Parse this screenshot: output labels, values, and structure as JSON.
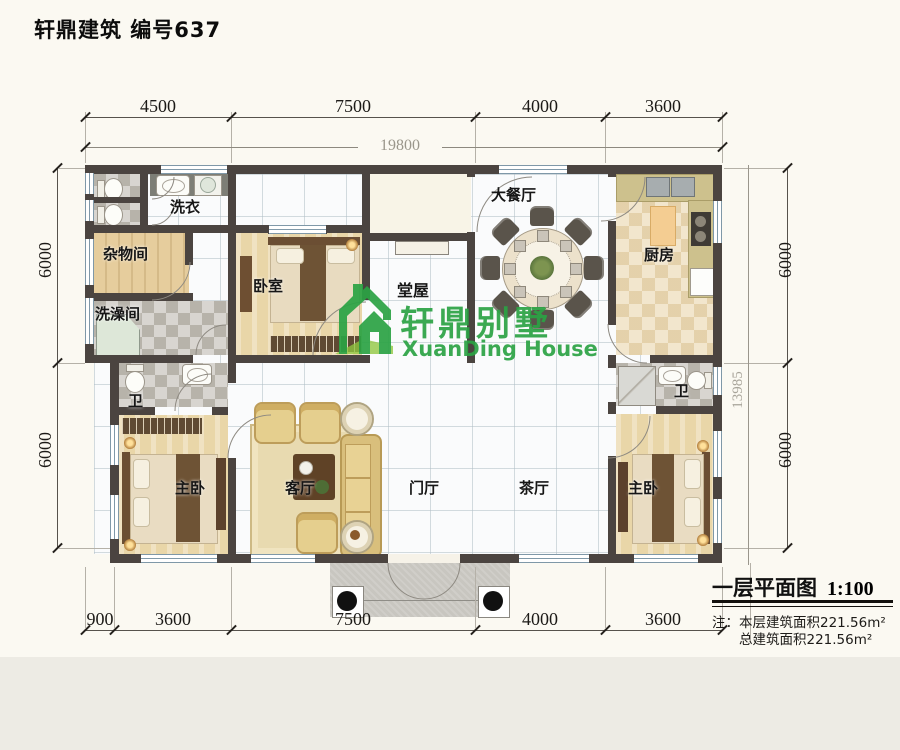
{
  "header": {
    "title": "轩鼎建筑 编号637"
  },
  "watermark": {
    "cn": "轩鼎别墅",
    "en": "XuanDing House",
    "logo_icon": "house-logo",
    "color": "#2ba344"
  },
  "rooms": {
    "laundry": {
      "label": "洗衣"
    },
    "storage": {
      "label": "杂物间"
    },
    "shower_room": {
      "label": "洗澡间"
    },
    "wc_left": {
      "label": "卫"
    },
    "master_left": {
      "label": "主卧"
    },
    "bedroom": {
      "label": "卧室"
    },
    "hall": {
      "label": "堂屋"
    },
    "living": {
      "label": "客厅"
    },
    "foyer": {
      "label": "门厅"
    },
    "tea_hall": {
      "label": "茶厅"
    },
    "dining": {
      "label": "大餐厅"
    },
    "kitchen": {
      "label": "厨房"
    },
    "wc_right": {
      "label": "卫"
    },
    "master_right": {
      "label": "主卧"
    }
  },
  "dimensions": {
    "top": {
      "segments": [
        "4500",
        "7500",
        "4000",
        "3600"
      ],
      "total": "19800"
    },
    "bottom": {
      "segments": [
        "900",
        "3600",
        "7500",
        "4000",
        "3600"
      ]
    },
    "left": {
      "segments": [
        "6000",
        "6000"
      ]
    },
    "right": {
      "segments": [
        "6000",
        "6000"
      ],
      "overall": "13985"
    }
  },
  "caption": {
    "title": "一层平面图",
    "scale": "1:100",
    "note_label": "注：",
    "note_area_floor": "本层建筑面积221.56m²",
    "note_area_total": "总建筑面积221.56m²"
  },
  "colors": {
    "wall": "#4b4440",
    "watermark_green": "#2ba344"
  }
}
